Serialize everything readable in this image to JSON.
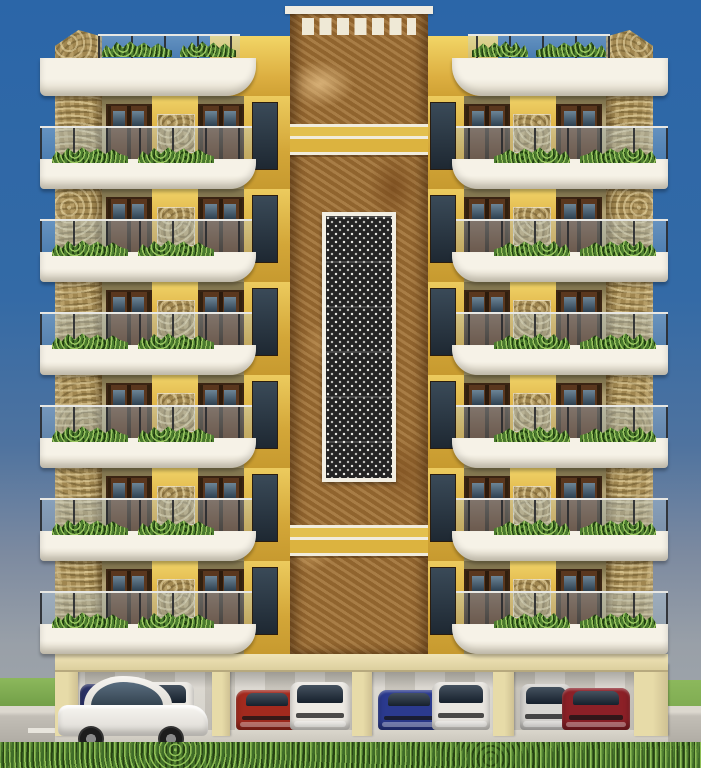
{
  "scene": {
    "type": "3d-architectural-render",
    "subject": "Front elevation of a multi-storey residential apartment building with stilt parking",
    "setting": "clear blue sky above, road with trimmed green hedge in the foreground"
  },
  "building": {
    "floors_above_parking": 6,
    "wings": 2,
    "door_bays_per_wing_per_floor": 2,
    "balconies": {
      "railing": "clear glass panels with slim dark posts",
      "planters": "green shrubs along every balcony edge and roof parapet"
    },
    "central_tower": {
      "cladding": "brown emperador marble",
      "features": [
        "white parapet cap",
        "row of white dentil squares",
        "yellow striped band upper",
        "white jali lattice screen panel",
        "yellow striped band lower"
      ]
    },
    "corner_columns": "beige rubble-stone cladding",
    "colors": {
      "accent_yellow": "#e0b445",
      "tan_wall": "#b0a074",
      "slab_white": "#f3efe4",
      "marble": "#9a6c33",
      "stone": "#ab9158",
      "door_wood": "#53301a",
      "door_glass": "#3b4f5f"
    }
  },
  "parking": {
    "type": "stilt ground-floor parking, four open bays",
    "pillar_color": "#e7dba8",
    "pillars": [
      {
        "x": 0,
        "w": 23
      },
      {
        "x": 157,
        "w": 18
      },
      {
        "x": 297,
        "w": 20
      },
      {
        "x": 438,
        "w": 21
      },
      {
        "x": 579,
        "w": 34
      }
    ],
    "cars": [
      {
        "name": "parked-car-navy-suv",
        "type": "suv",
        "color": "#2a3166",
        "x": 25,
        "w": 64,
        "h": 46
      },
      {
        "name": "parked-car-white-suv-1",
        "type": "suv",
        "color": "#edeae4",
        "x": 71,
        "w": 68,
        "h": 48
      },
      {
        "name": "parked-car-red-sedan",
        "type": "sedan",
        "color": "#a32a1e",
        "x": 181,
        "w": 62,
        "h": 40
      },
      {
        "name": "parked-car-white-suv-2",
        "type": "suv",
        "color": "#edeae4",
        "x": 235,
        "w": 60,
        "h": 48
      },
      {
        "name": "parked-car-blue-sedan",
        "type": "sedan",
        "color": "#2b3a8e",
        "x": 323,
        "w": 62,
        "h": 40
      },
      {
        "name": "parked-car-white-suv-3",
        "type": "suv",
        "color": "#e9e6e0",
        "x": 377,
        "w": 58,
        "h": 48
      },
      {
        "name": "parked-car-silver-suv",
        "type": "suv",
        "color": "#d8d6d2",
        "x": 465,
        "w": 52,
        "h": 46
      },
      {
        "name": "parked-car-darkred-sedan",
        "type": "sedan",
        "color": "#8c2027",
        "x": 507,
        "w": 68,
        "h": 42
      }
    ]
  },
  "foreground_car": {
    "name": "white-crossover",
    "type": "crossover side view",
    "color": "#f7f5f1",
    "facing": "right"
  },
  "environment": {
    "sky_top": "#2b66a8",
    "sky_horizon": "#9aa1a9",
    "grass": "#7fae52",
    "road": "#bdb9b1",
    "road_dashes": "#e8e5dd",
    "hedge": "#3f6b28"
  }
}
